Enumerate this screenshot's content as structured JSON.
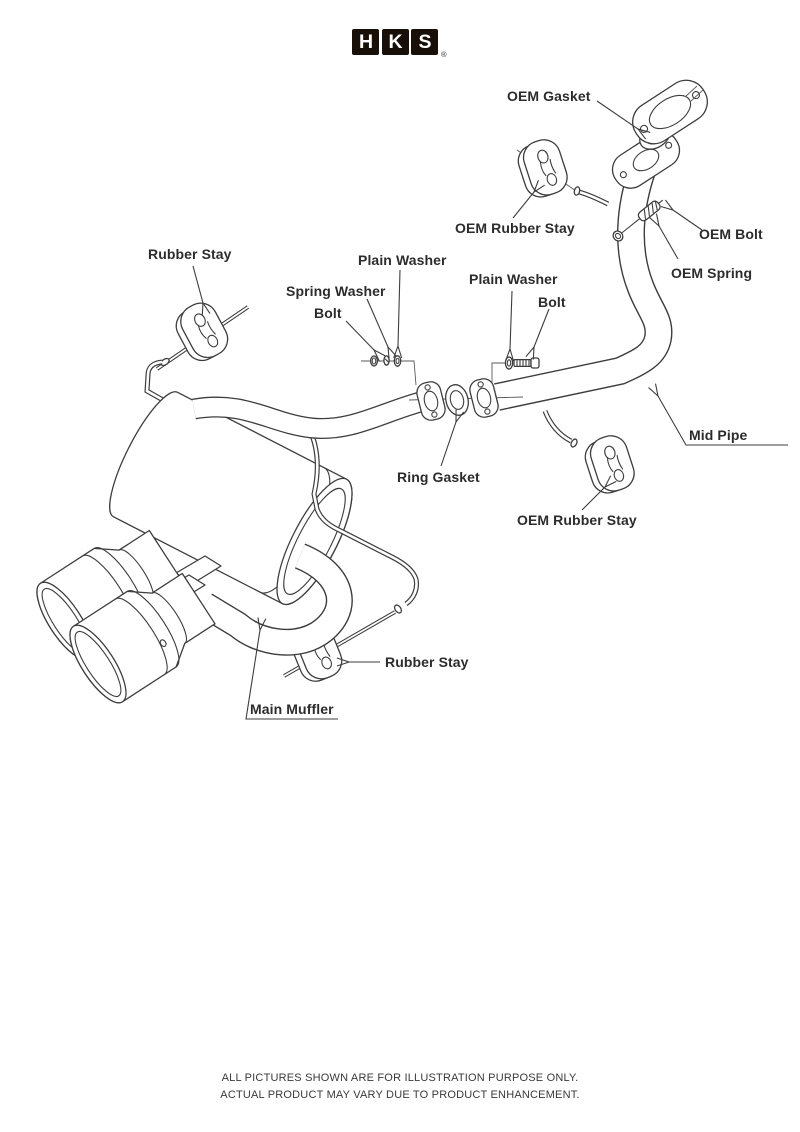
{
  "colors": {
    "background": "#ffffff",
    "line": "#3d3d3d",
    "logo_background": "#181008",
    "logo_letter": "#ffffff",
    "label_text": "#2c2c2c"
  },
  "logo": {
    "letters": [
      "H",
      "K",
      "S"
    ],
    "registered_mark": "®"
  },
  "diagram_labels": {
    "oem_gasket": "OEM Gasket",
    "oem_rubber_stay_top": "OEM Rubber Stay",
    "oem_bolt": "OEM Bolt",
    "oem_spring": "OEM Spring",
    "rubber_stay_left": "Rubber Stay",
    "plain_washer_left": "Plain Washer",
    "spring_washer": "Spring Washer",
    "bolt_left": "Bolt",
    "plain_washer_right": "Plain Washer",
    "bolt_right": "Bolt",
    "mid_pipe": "Mid Pipe",
    "ring_gasket": "Ring Gasket",
    "oem_rubber_stay_lower": "OEM Rubber Stay",
    "rubber_stay_bottom": "Rubber Stay",
    "main_muffler": "Main Muffler"
  },
  "footer": {
    "line1": "ALL PICTURES SHOWN ARE FOR ILLUSTRATION PURPOSE ONLY.",
    "line2": "ACTUAL PRODUCT MAY VARY DUE TO PRODUCT ENHANCEMENT."
  }
}
